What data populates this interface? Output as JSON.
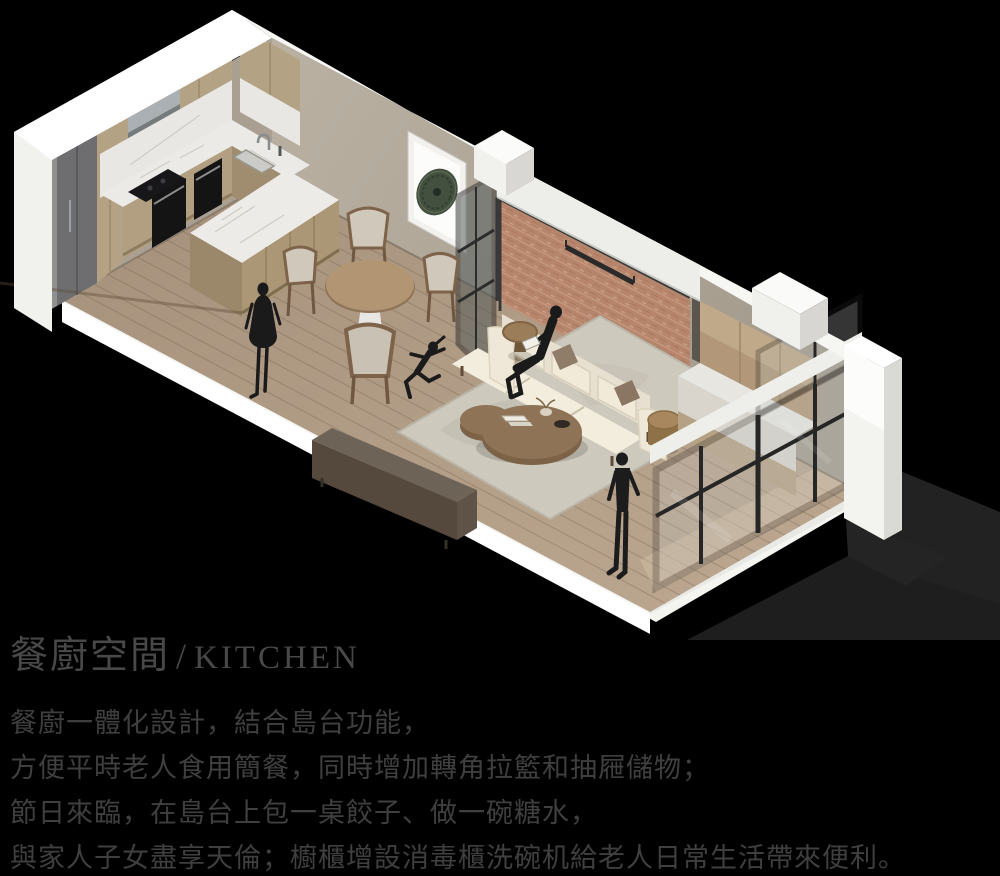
{
  "title": {
    "zh": "餐廚空間",
    "sep": "/",
    "en": "KITCHEN"
  },
  "description": {
    "lines": [
      "餐廚一體化設計，結合島台功能，",
      "方便平時老人食用簡餐，同時增加轉角拉籃和抽屜儲物；",
      "節日來臨，在島台上包一桌餃子、做一碗糖水，",
      "與家人子女盡享天倫；櫥櫃增設消毒櫃洗碗机給老人日常生活帶來便利。"
    ]
  },
  "scene": {
    "type": "isometric-interior-rendering",
    "objects": [
      "kitchen-cabinets",
      "fridge-column",
      "range-hood",
      "cooktop",
      "double-oven",
      "sink",
      "island-peninsula",
      "dining-table",
      "dining-chairs",
      "wall-artwork",
      "glass-partition-door",
      "brick-feature-wall",
      "wall-lamp",
      "sofa",
      "coffee-table",
      "side-tables",
      "area-rug",
      "tv-console",
      "balcony-cabinets",
      "window-wall",
      "human-silhouettes"
    ],
    "palette": {
      "background": "#000000",
      "exterior_wall_white": "#f4f4f1",
      "interior_wall_beige": "#b6ad9f",
      "brick_terracotta": "#b08166",
      "wood_cabinet": "#b3a084",
      "marble": "#eceae6",
      "floor_wood": "#b09b85",
      "sofa_cream": "#f0e9da",
      "frame_black": "#2c2c2c",
      "figure_silhouette": "#1a1a1a",
      "title_text": "#484848",
      "body_text": "#3f3f3f"
    }
  }
}
